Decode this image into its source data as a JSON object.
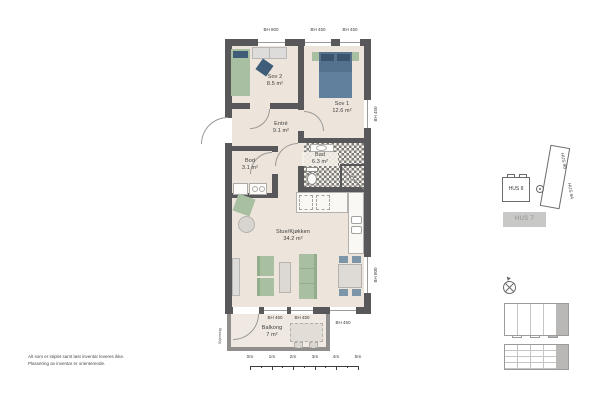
{
  "plan": {
    "rooms": {
      "sov2": {
        "name": "Sov 2",
        "area": "8.5 m²"
      },
      "sov1": {
        "name": "Sov 1",
        "area": "12.6 m²"
      },
      "entre": {
        "name": "Entré",
        "area": "9.1 m²"
      },
      "bod": {
        "name": "Bod",
        "area": "3.1 m²"
      },
      "bad": {
        "name": "Bad",
        "area": "6.3 m²"
      },
      "stue": {
        "name": "Stue/Kjøkken",
        "area": "34.2 m²"
      },
      "balkong": {
        "name": "Balkong",
        "area": "7 m²"
      }
    },
    "window_labels": {
      "top1": "BH 800",
      "top2": "BH 450",
      "top3": "BH 450",
      "right_top": "BH 450",
      "right_bottom": "BH 800",
      "bottom1": "BH 450",
      "bottom2": "BH 450",
      "bottom3": "BH 450"
    },
    "screen_label": "Skjerming"
  },
  "site": {
    "hus8": "HUS 8",
    "hus9b": "HUS 9B",
    "hus9a": "HUS 9A",
    "hus7": "HUS 7"
  },
  "scalebar": {
    "ticks": [
      "0m",
      "1m",
      "2m",
      "3m",
      "4m",
      "5m"
    ]
  },
  "notes": {
    "line1": "Alt som er stiplet samt løst inventar leveres ikke.",
    "line2": "Plassering av inventar er orienterende."
  },
  "colors": {
    "wall": "#58585a",
    "floor": "#ede5dc",
    "furniture_green": "#a9bfa2",
    "furniture_blue": "#54718e",
    "site_highlight": "#b9b8b6"
  }
}
